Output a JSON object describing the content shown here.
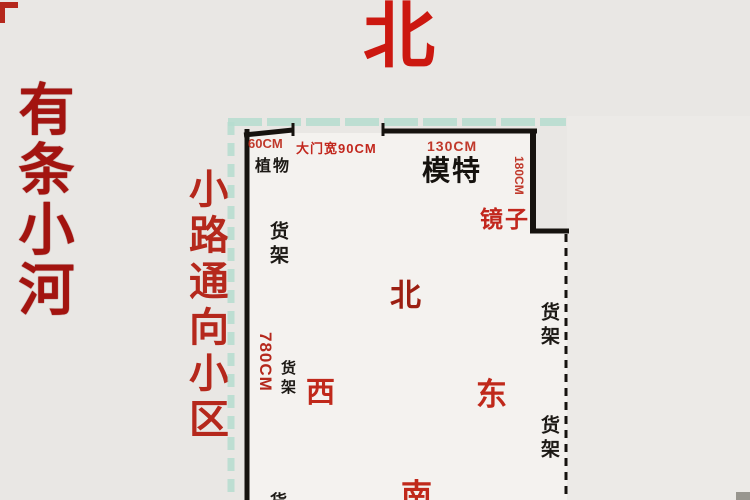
{
  "surroundings": {
    "river_note": "有条小河",
    "road_note": "小路通向小区"
  },
  "compass_north": "北",
  "plan": {
    "dims": {
      "plant_width": "60CM",
      "door": "大门宽90CM",
      "mannequin_width": "130CM",
      "mirror_height": "180CM",
      "west_wall_length": "780CM"
    },
    "items": {
      "plant": "植物",
      "mannequin": "模特",
      "mirror": "镜子",
      "shelf_left_upper": "货架",
      "shelf_left_lower": "货架",
      "shelf_right_upper": "货架",
      "shelf_right_lower": "货架",
      "shelf_bottom_partial": "货"
    },
    "directions": {
      "north": "北",
      "west": "西",
      "east": "东",
      "south": "南"
    }
  },
  "colors": {
    "page_background": "#e9e7e4",
    "plan_interior": "#f4f2ef",
    "red_annotation": "#b5281c",
    "dark_red_annotation": "#a31410",
    "black_label": "#1c1915",
    "teal_dash": "#b6ddd0",
    "wall": "#16130f"
  }
}
